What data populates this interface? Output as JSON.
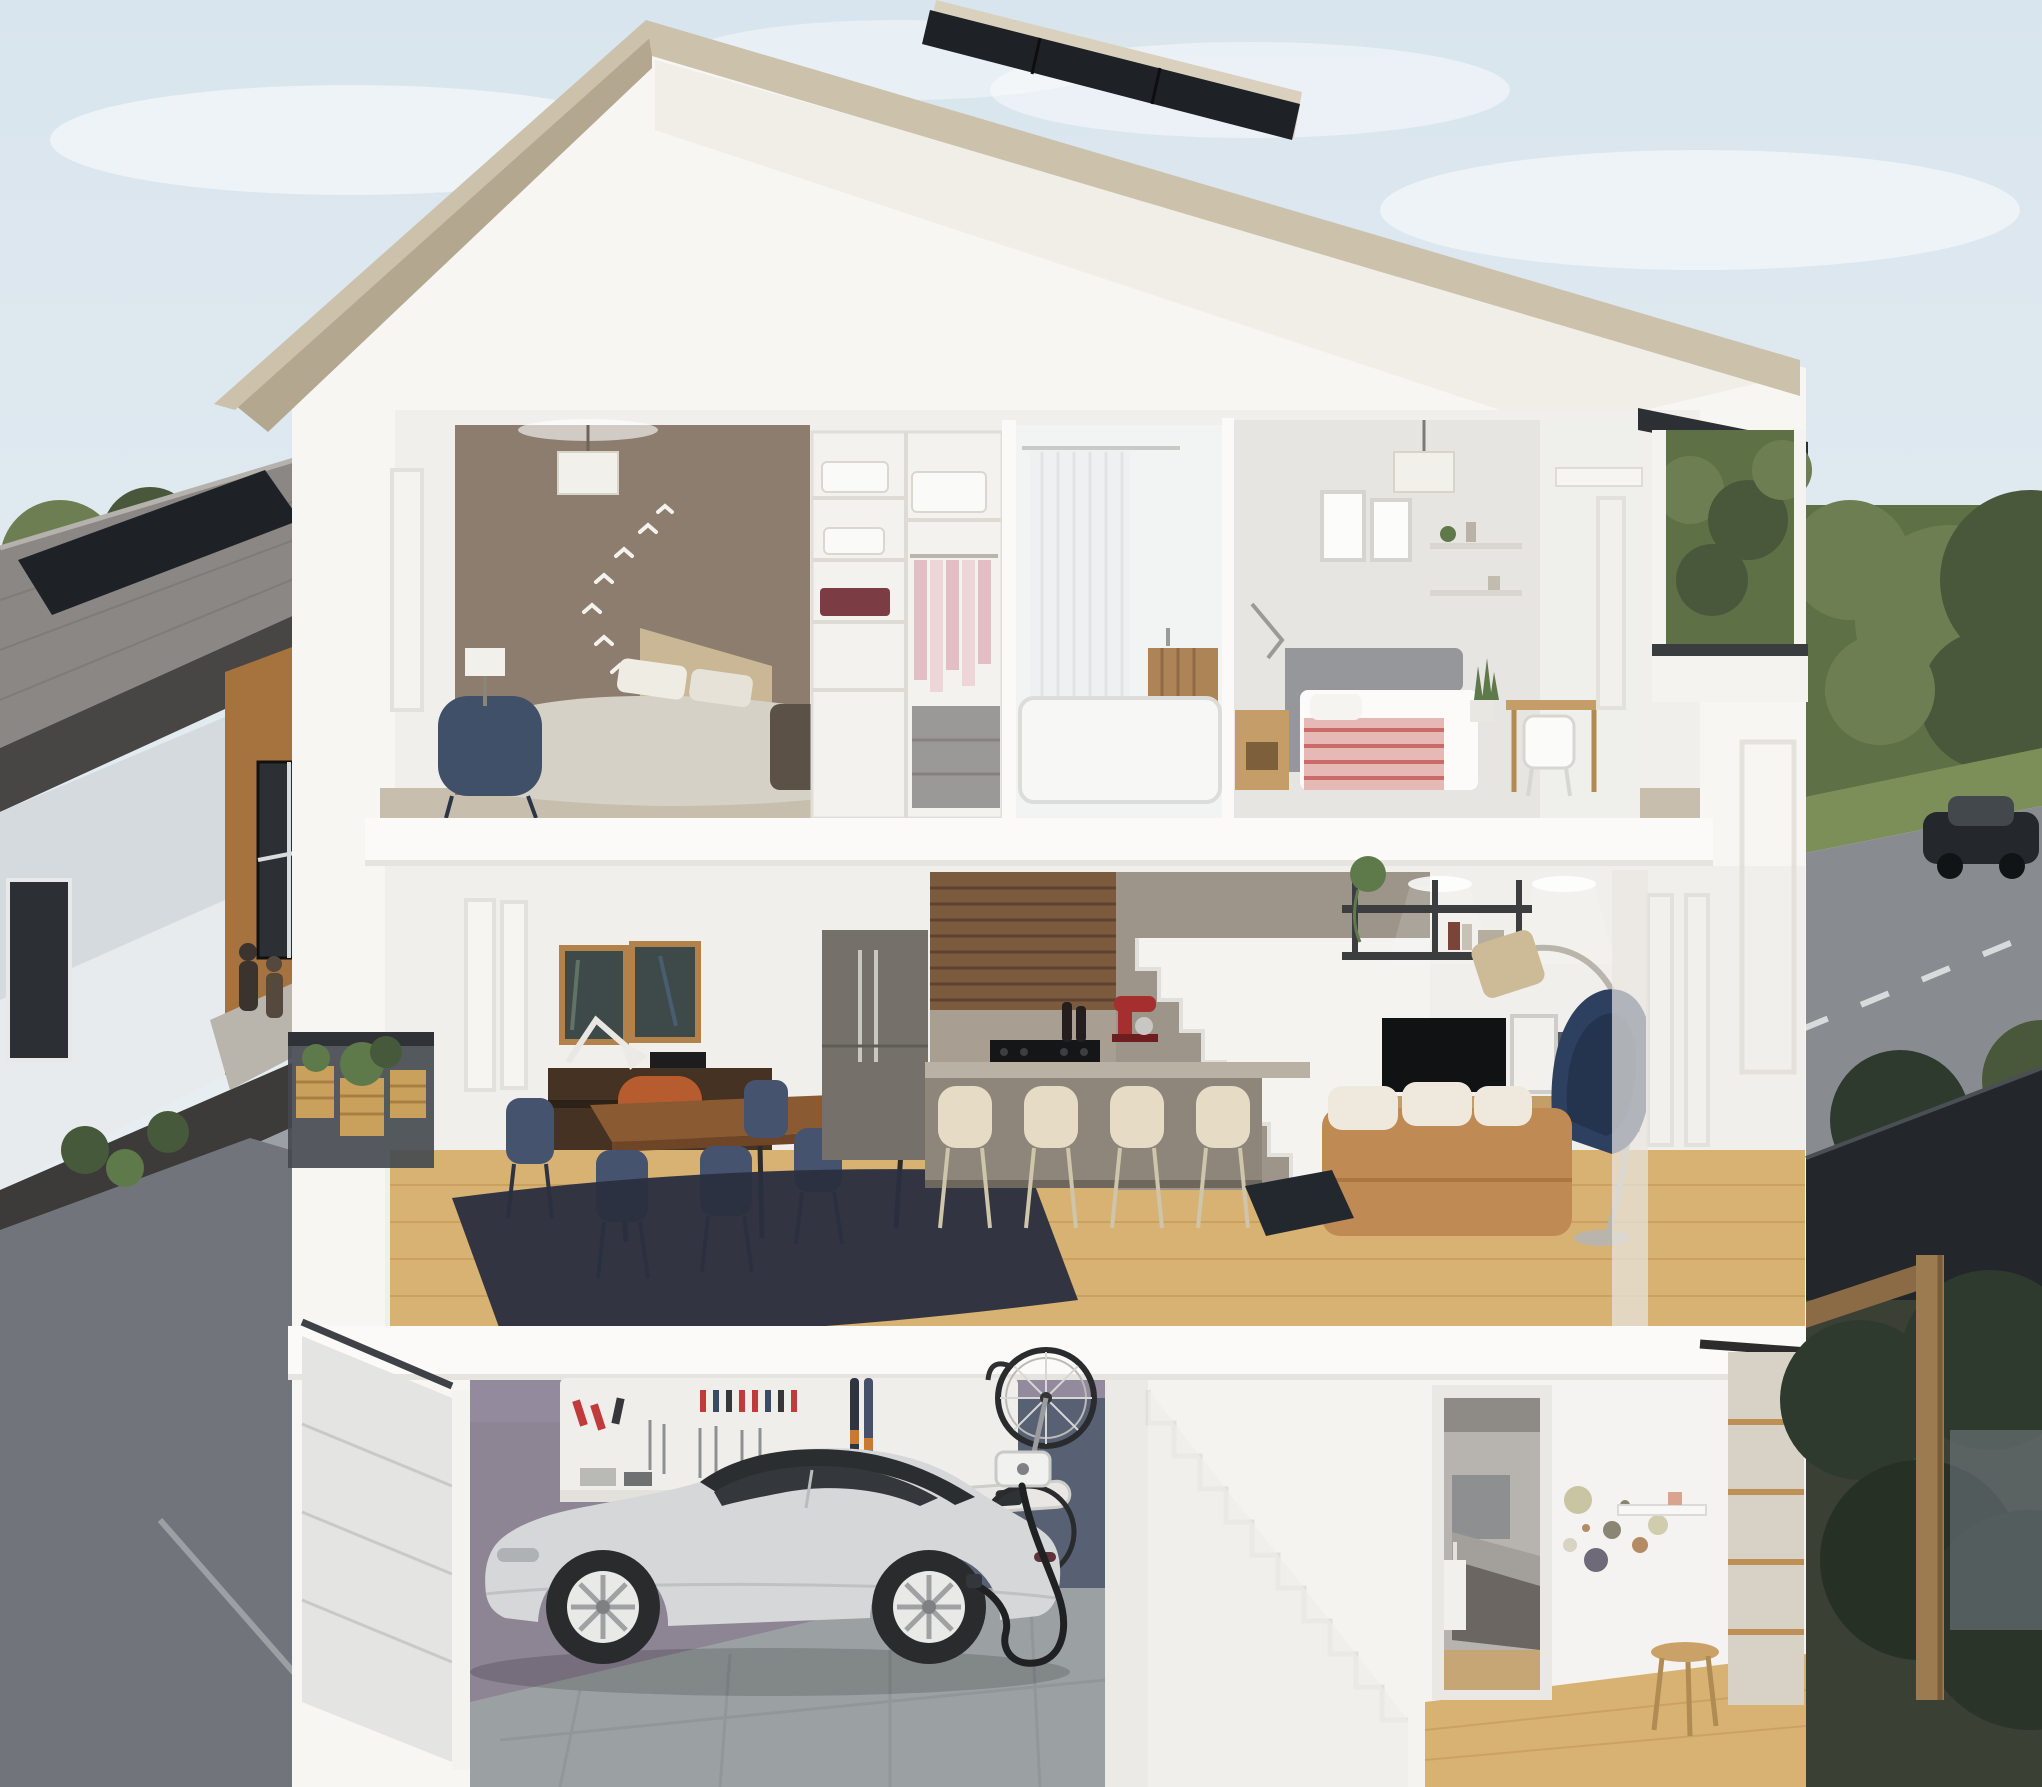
{
  "scene": {
    "type": "photorealistic 3D architectural cutaway rendering",
    "description": "Cross-section view of a modern three-storey townhouse showing furnished interiors on all levels, with a rooftop solar panel, an electric car charging in the garage, a neighbouring townhouse row on the left, a rear lane, and a tree-lined street with a passing car on the right.",
    "sky": "pale blue with soft white clouds"
  },
  "house": {
    "roof": {
      "features": [
        "white gable roof",
        "tan fascia band",
        "rooftop solar panel on right slope"
      ]
    },
    "upper_floor": {
      "rooms": [
        {
          "name": "primary bedroom",
          "objects": [
            "taupe accent wall",
            "white bird wall decals",
            "white drum pendant light",
            "bed with light grey duvet and beige headboard",
            "dark bench at foot of bed",
            "navy armchair",
            "table lamp",
            "beige carpet"
          ]
        },
        {
          "name": "walk-in closet",
          "objects": [
            "white shelving unit",
            "folded linens",
            "maroon storage bins",
            "hanging rod with pink clothes",
            "grey drawer stack"
          ]
        },
        {
          "name": "bathroom",
          "objects": [
            "white shower curtain",
            "white bathtub",
            "floating wood vanity"
          ]
        },
        {
          "name": "second bedroom",
          "objects": [
            "white drum pendant light",
            "two framed prints",
            "wall shelves with decor",
            "grey upholstered bed with pink striped bedding",
            "wood nightstand",
            "task lamp",
            "snake plant",
            "small desk with white spindle chair",
            "edge-on window"
          ]
        }
      ]
    },
    "main_floor": {
      "rooms": [
        {
          "name": "balcony",
          "objects": [
            "dark metal railing",
            "wood crate planters with greenery"
          ]
        },
        {
          "name": "dining area",
          "objects": [
            "two dark framed artworks",
            "dark wood console with white task lamp",
            "orange chair",
            "dark wood dining table",
            "navy dining chairs",
            "navy shag rug",
            "light oak floor",
            "tall edge-on windows"
          ]
        },
        {
          "name": "kitchen",
          "objects": [
            "grey-taupe tall cabinets and integrated fridge",
            "walnut slat feature wall",
            "black gas cooktop",
            "red stand mixer",
            "wine bottles",
            "grey island with counter overhang",
            "four cream bar stools"
          ]
        },
        {
          "name": "staircase to upper floor",
          "objects": [
            "white cutaway stair profile against taupe wall"
          ]
        },
        {
          "name": "living room",
          "objects": [
            "black wall shelf with plants and books",
            "flat-screen TV",
            "wood media console",
            "leaning picture frames",
            "gold arc floor lamp",
            "navy lounge chair",
            "caramel leather sofa with white cushions",
            "dark rug",
            "recessed ceiling lights",
            "edge-on windows"
          ]
        }
      ]
    },
    "lower_floor": {
      "rooms": [
        {
          "name": "garage",
          "objects": [
            "white sectional garage door",
            "mauve feature wall",
            "white tool wall with red and blue hand tools",
            "pair of skis",
            "vertically hung bicycle",
            "white snowboard",
            "wall-mounted EV charger",
            "black charging cable",
            "silver electric sedan with black glass roof and white rims",
            "grey tile floor"
          ]
        },
        {
          "name": "staircase to main floor",
          "objects": [
            "white cutaway stair profile"
          ]
        },
        {
          "name": "flex bedroom and entry",
          "objects": [
            "doorway to small bedroom with grey bed",
            "circular dot wall decals",
            "small white shelf",
            "wood stool",
            "wood-framed glass barn door",
            "light oak floor"
          ]
        }
      ]
    },
    "right_side": {
      "features": [
        "dark flat-roof eave",
        "roof deck opening with trees beyond",
        "white parapet with dark cap"
      ]
    }
  },
  "surroundings": {
    "left": {
      "features": [
        "townhouse row with grey shingle roof",
        "rooftop solar panel",
        "white and cedar facade panels",
        "dark windows",
        "two people standing at entry",
        "shrubs with red flowers",
        "asphalt rear lane"
      ]
    },
    "right": {
      "features": [
        "green hedge and large trees",
        "grass verge",
        "asphalt street with dashed lane lines",
        "dark sedan driving",
        "dark wood pergola carport",
        "dense shrubs"
      ]
    }
  },
  "palette": {
    "sky_top": "#d9e5ee",
    "sky_bottom": "#eff3f4",
    "cloud": "#ffffff",
    "fascia": "#ccc1ab",
    "soffit": "#b3a88f",
    "roof_shade": "#f1eee8",
    "shell": "#f7f6f2",
    "shell_shade": "#ecebe6",
    "slab": "#fbfaf8",
    "slab_shadow": "#d9d6cf",
    "room_white": "#f0efec",
    "wall_taupe": "#8c7d6e",
    "wall_gray": "#e6e5e2",
    "wall_gray2": "#dcdbd8",
    "carpet": "#c7beae",
    "solar": "#1e2226",
    "solar_frame": "#d9d0bd",
    "bird_white": "#f4f2ec",
    "lamp_shade": "#f2f0ea",
    "bed_duvet": "#d5d1c6",
    "bed_head": "#c9b795",
    "bench_dark": "#5c5146",
    "chair_blue": "#3f5068",
    "closet_shelf": "#f3f2ef",
    "closet_pink": "#e3bfc5",
    "closet_pink2": "#eed6d8",
    "closet_red": "#7c3c44",
    "drawer_gray": "#9b9997",
    "linen_white": "#fafaf8",
    "tub_white": "#f7f7f6",
    "curtain": "#eef0f1",
    "curtain_line": "#e2e4e4",
    "vanity_wood": "#ad8455",
    "bed2_gray": "#96979a",
    "bedding_pink": "#e6b9b6",
    "bedding_stripe": "#c96b6b",
    "wood_light": "#c59d69",
    "plant_green": "#5f7a4a",
    "plant_dark": "#46593a",
    "frame_wood": "#b3824a",
    "art_dark": "#3e4a4a",
    "console_dark": "#463223",
    "table_wood": "#8a5a33",
    "chair_navy": "#46536e",
    "chair_navy_dark": "#39445c",
    "rug_navy": "#2b303f",
    "chair_orange": "#b65c2e",
    "floor_oak": "#d8b273",
    "floor_oak_line": "#c09450",
    "cab_gray": "#75706a",
    "slat_wood": "#7b5a3d",
    "slat_line": "#5e4430",
    "kit_wall": "#a89f92",
    "counter": "#b9b1a4",
    "island": "#8e867a",
    "stool_cream": "#e6dcc5",
    "stool_leg": "#cfc5ab",
    "mixer_red": "#a52f2f",
    "stair_white": "#f4f3f0",
    "stair_shade": "#e1e0db",
    "stair_wall": "#9d948a",
    "shelf_black": "#3b3d3f",
    "tv_black": "#101214",
    "lamp_gold": "#cdbb97",
    "lamp_arc": "#b9b5ac",
    "sofa_tan": "#c08a55",
    "sofa_cushion": "#efe8dc",
    "window_frame": "#e3e1db",
    "rail_dark": "#43484f",
    "rail_cap": "#2f3338",
    "planter_wood": "#c9a05c",
    "garage_purple": "#8d8494",
    "garage_purple_light": "#968da1",
    "garage_navy": "#586074",
    "tile": "#9ba1a3",
    "tile_line": "#8b9194",
    "tool_panel": "#efeeea",
    "tool_red": "#c03b3b",
    "tool_blue": "#3b4a63",
    "tool_dark": "#35373a",
    "tool_gray": "#8e9092",
    "ski_dark": "#2e3440",
    "ski_blue": "#46506b",
    "ski_orange": "#c77a33",
    "board_white": "#e9e7e3",
    "car_silver": "#d5d7d8",
    "car_dark": "#9ea1a3",
    "glass": "#34383c",
    "glass_roof": "#2b2e31",
    "rim": "#e9e9e7",
    "tire": "#292b2d",
    "cable": "#1f2123",
    "charger_white": "#f1f1ef",
    "door_light": "#e4e4e2",
    "door_line": "#c9c9c6",
    "track_dark": "#3e4246",
    "barn_wood": "#bd9055",
    "barn_glass": "#d8d2c6",
    "barn_rail": "#2c2c2c",
    "flex_wall": "#f4f3f1",
    "decal1": "#c9c4a2",
    "decal2": "#8b8574",
    "decal3": "#5f5b6b",
    "decal4": "#d9d3c4",
    "decal5": "#b48b63",
    "stool_wood": "#caa268",
    "n_roof": "#8a8784",
    "n_ridge": "#b5b2ad",
    "n_fascia": "#474645",
    "n_white": "#e7ebee",
    "n_white_shade": "#cfd6da",
    "n_cedar": "#a6733e",
    "n_window": "#2c3034",
    "n_band": "#3c3b39",
    "n_lower": "#9aa0a5",
    "n_garage": "#30343a",
    "walkway": "#b9b4ac",
    "lane": "#71757b",
    "curb": "#9aa0a4",
    "person1": "#3b342e",
    "person2": "#55483c",
    "hedge": "#5d7046",
    "leaf": "#6d7f52",
    "leaf_dark": "#49583a",
    "grass": "#7d8f58",
    "road": "#888c90",
    "road_line": "#d8dbdc",
    "car2": "#24272b",
    "car2_glass": "#43484d",
    "pergola": "#23272b",
    "pergola_wood": "#9d7b50",
    "foliage_dark": "#2f3a2e",
    "ground_dark": "#3a4034",
    "wall_glimpse": "#768089",
    "flower_red": "#a33b4e",
    "eave_dark": "#2c3034",
    "parapet_cap": "#3a3d40"
  }
}
